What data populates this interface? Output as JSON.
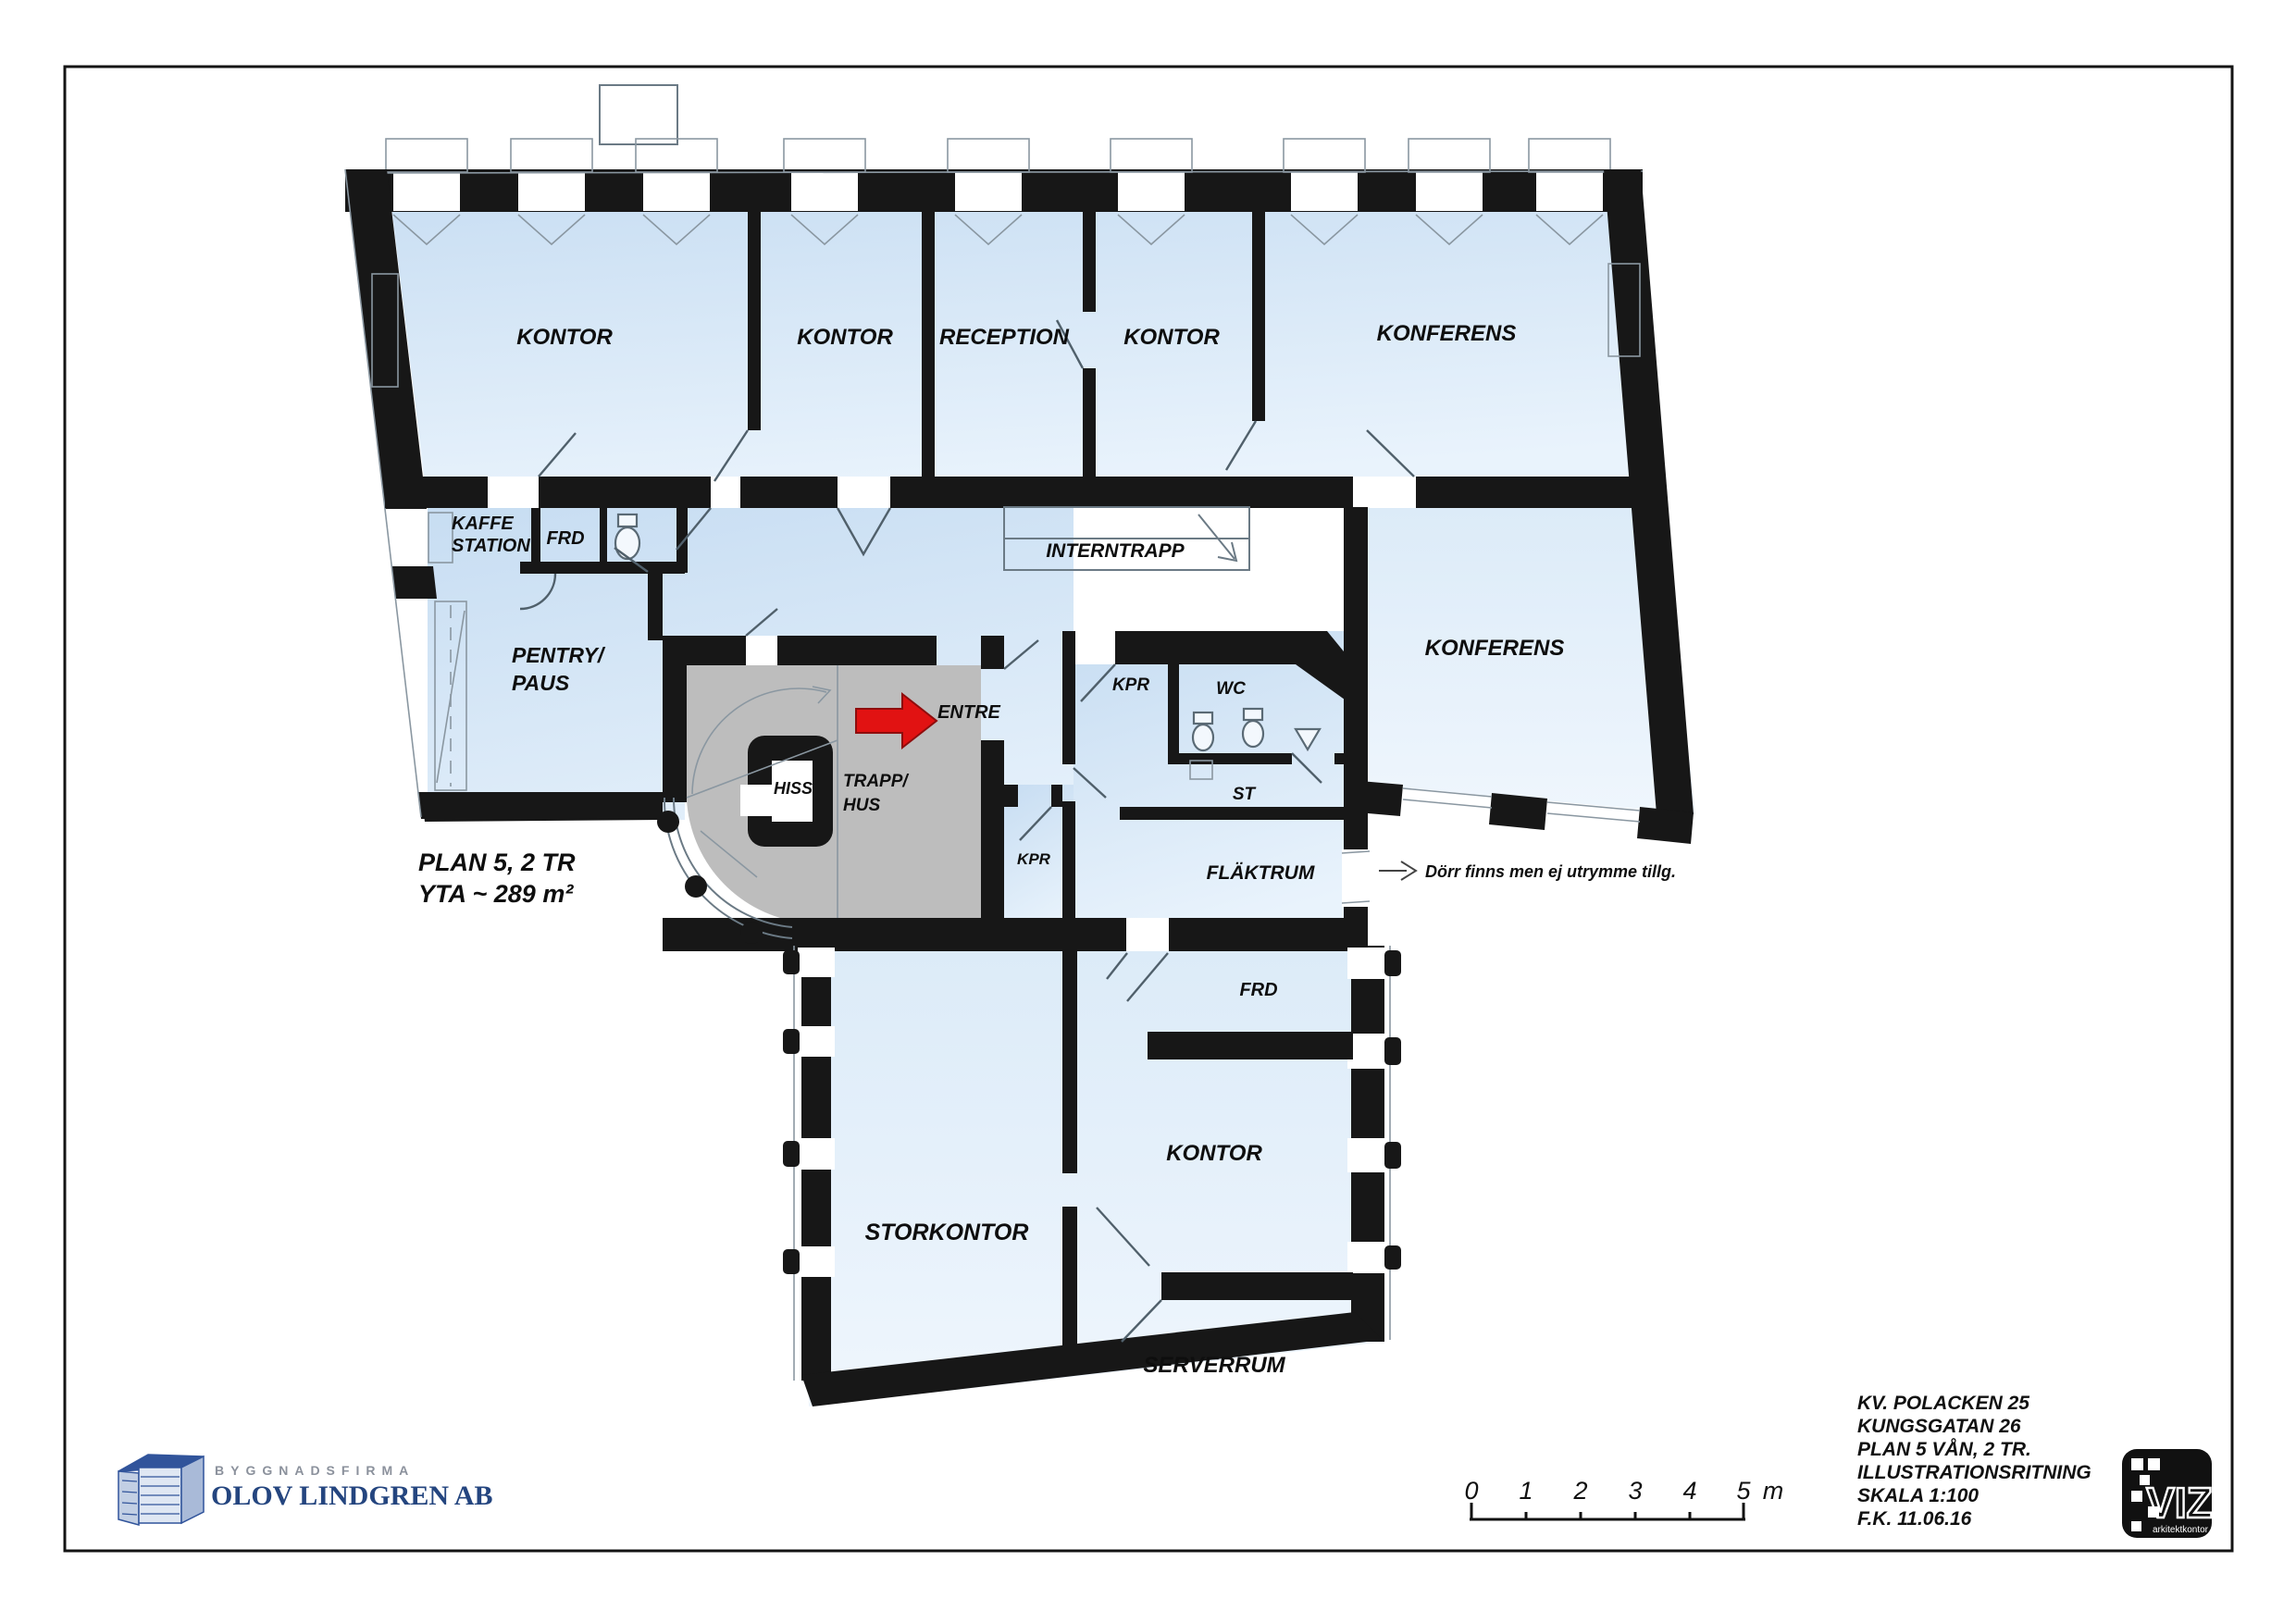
{
  "texts": {
    "plan_label": "PLAN 5, 2 TR",
    "area_label": "YTA ~ 289 m²",
    "annotation": "Dörr finns men ej utrymme tillg."
  },
  "rooms": {
    "kontor_nw": "KONTOR",
    "kontor_n": "KONTOR",
    "reception": "RECEPTION",
    "kontor_ne": "KONTOR",
    "konferens_n": "KONFERENS",
    "kaffe_1": "KAFFE",
    "kaffe_2": "STATION",
    "frd_small": "FRD",
    "pentry_1": "PENTRY/",
    "pentry_2": "PAUS",
    "interntrapp": "INTERNTRAPP",
    "entre": "ENTRE",
    "hiss": "HISS",
    "trapphus_1": "TRAPP/",
    "trapphus_2": "HUS",
    "kpr_upper": "KPR",
    "wc": "WC",
    "st": "ST",
    "kpr_lower": "KPR",
    "flaktrum": "FLÄKTRUM",
    "konferens_e": "KONFERENS",
    "frd_lower": "FRD",
    "kontor_s": "KONTOR",
    "storkontor": "STORKONTOR",
    "serverrum": "SERVERRUM"
  },
  "title_block": {
    "line1": "KV. POLACKEN 25",
    "line2": "KUNGSGATAN 26",
    "line3": "PLAN 5 VÅN, 2 TR.",
    "line4": "ILLUSTRATIONSRITNING",
    "line5": "SKALA 1:100",
    "line6": "F.K. 11.06.16"
  },
  "logo": {
    "tagline": "BYGGNADSFIRMA",
    "company": "OLOV LINDGREN AB"
  },
  "viz": {
    "name": "VIZ",
    "subtitle": "arkitektkontor"
  },
  "scale_bar": {
    "t0": "0",
    "t1": "1",
    "t2": "2",
    "t3": "3",
    "t4": "4",
    "t5": "5",
    "unit": "m"
  },
  "colors": {
    "wall": "#171717",
    "room_blue": "#cfe3f5",
    "room_blue_pale": "#e6f0fa",
    "core_gray": "#bdbdbd",
    "accent_red": "#e11212",
    "logo_blue": "#24457f",
    "logo_gray": "#8b919c"
  }
}
